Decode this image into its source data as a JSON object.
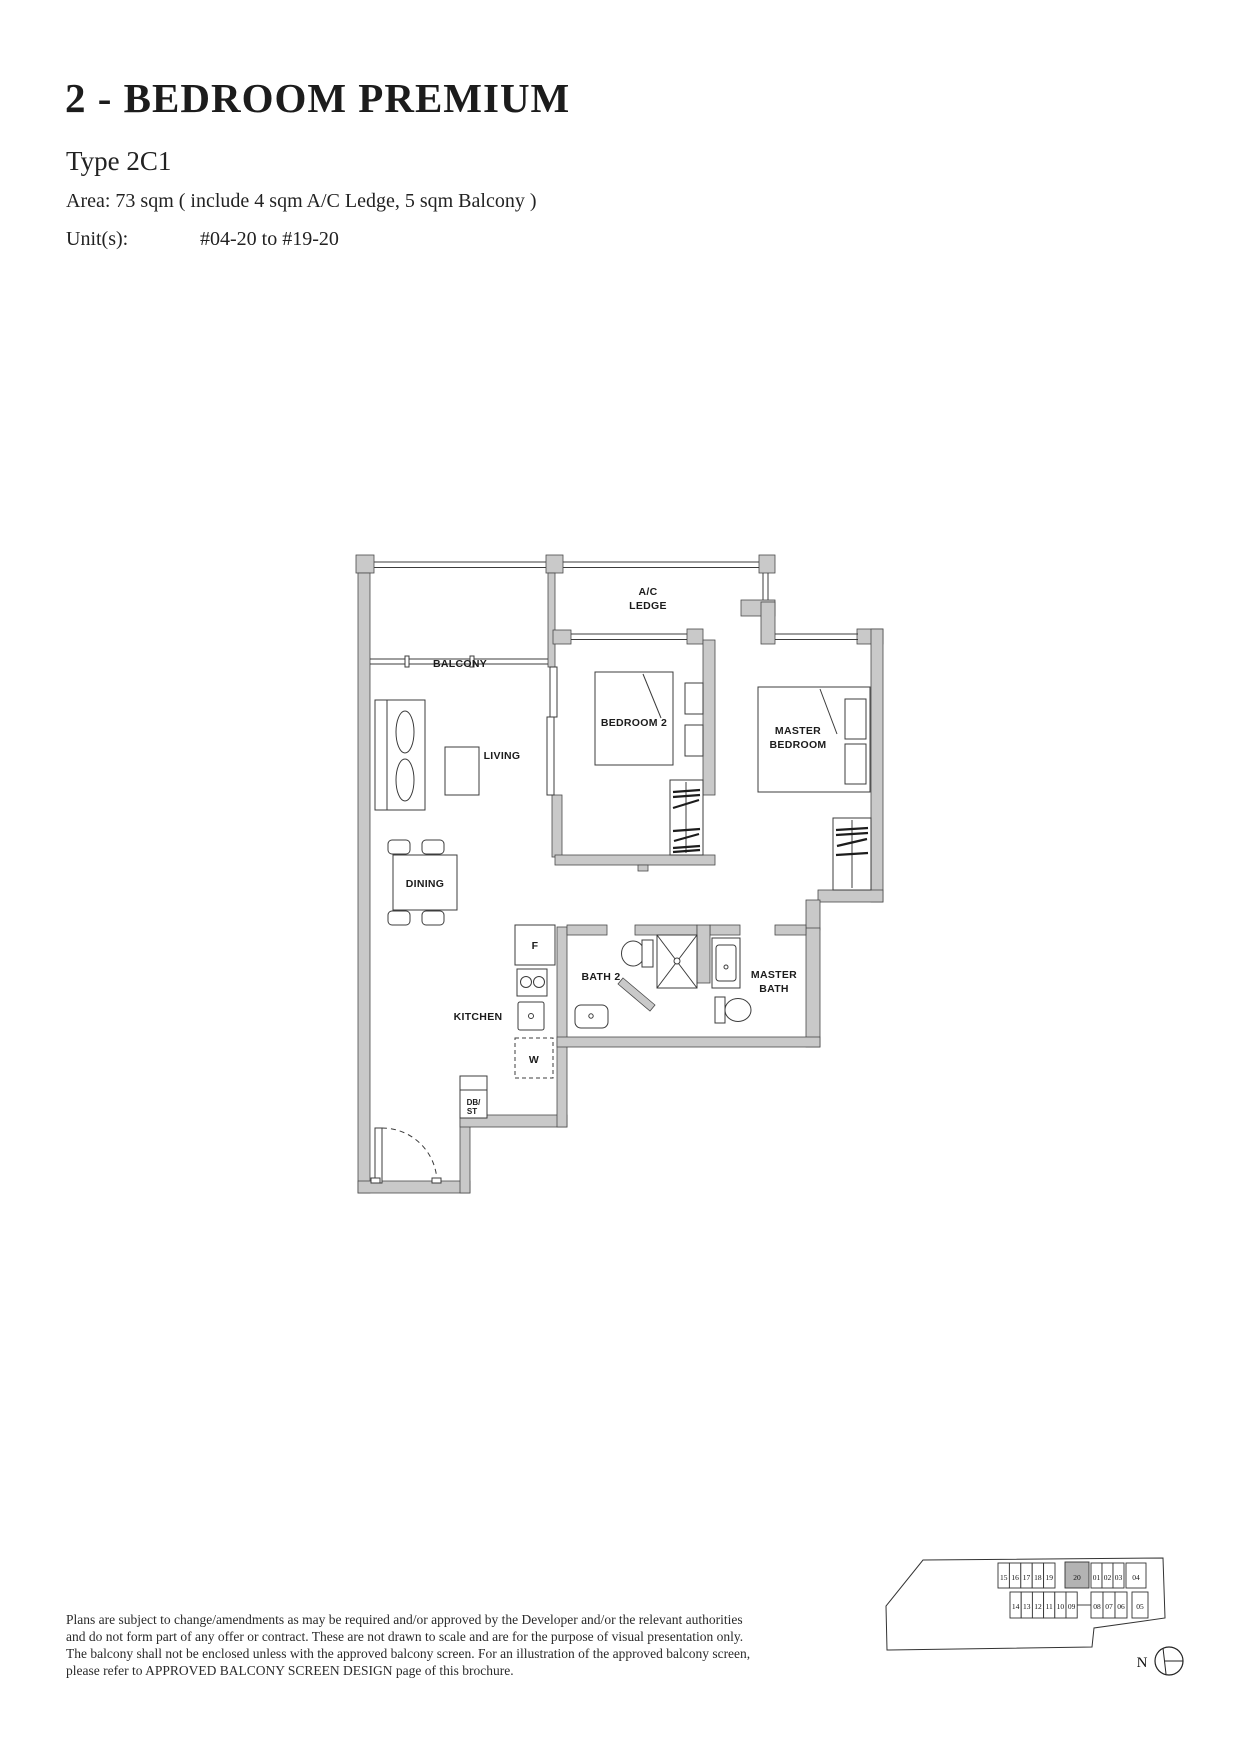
{
  "header": {
    "title": "2 - BEDROOM PREMIUM",
    "type_label": "Type 2C1",
    "area_line": "Area: 73 sqm ( include 4 sqm A/C Ledge, 5 sqm Balcony )",
    "units_label": "Unit(s):",
    "units_value": "#04-20 to #19-20"
  },
  "floorplan": {
    "rooms": {
      "balcony": "BALCONY",
      "ac_ledge_line1": "A/C",
      "ac_ledge_line2": "LEDGE",
      "living": "LIVING",
      "dining": "DINING",
      "bedroom2": "BEDROOM 2",
      "master_bedroom_line1": "MASTER",
      "master_bedroom_line2": "BEDROOM",
      "kitchen": "KITCHEN",
      "bath2": "BATH 2",
      "master_bath_line1": "MASTER",
      "master_bath_line2": "BATH"
    },
    "fixtures": {
      "fridge": "F",
      "washer": "W",
      "db_st_line1": "DB/",
      "db_st_line2": "ST"
    }
  },
  "disclaimer": {
    "lines": [
      "Plans are subject to change/amendments as may be required and/or approved by the Developer and/or the relevant authorities",
      "and do not form part of any offer or contract. These are not drawn to scale and are for the purpose of visual presentation only.",
      "The balcony shall not be enclosed unless with the approved balcony screen. For an illustration of the approved balcony screen,",
      "please refer to APPROVED BALCONY SCREEN DESIGN page of this brochure."
    ]
  },
  "keyplan": {
    "north_label": "N",
    "highlighted_unit": "20",
    "row1": [
      "15",
      "16",
      "17",
      "18",
      "19",
      "20",
      "01",
      "02",
      "03",
      "04"
    ],
    "row2": [
      "14",
      "13",
      "12",
      "11",
      "10",
      "09",
      "08",
      "07",
      "06",
      "05"
    ]
  },
  "colors": {
    "wall_gray": "#c9c9c9",
    "keyplan_highlight_gray": "#b3b3b3",
    "line": "#3c3c3c",
    "text": "#1f1f1f"
  }
}
